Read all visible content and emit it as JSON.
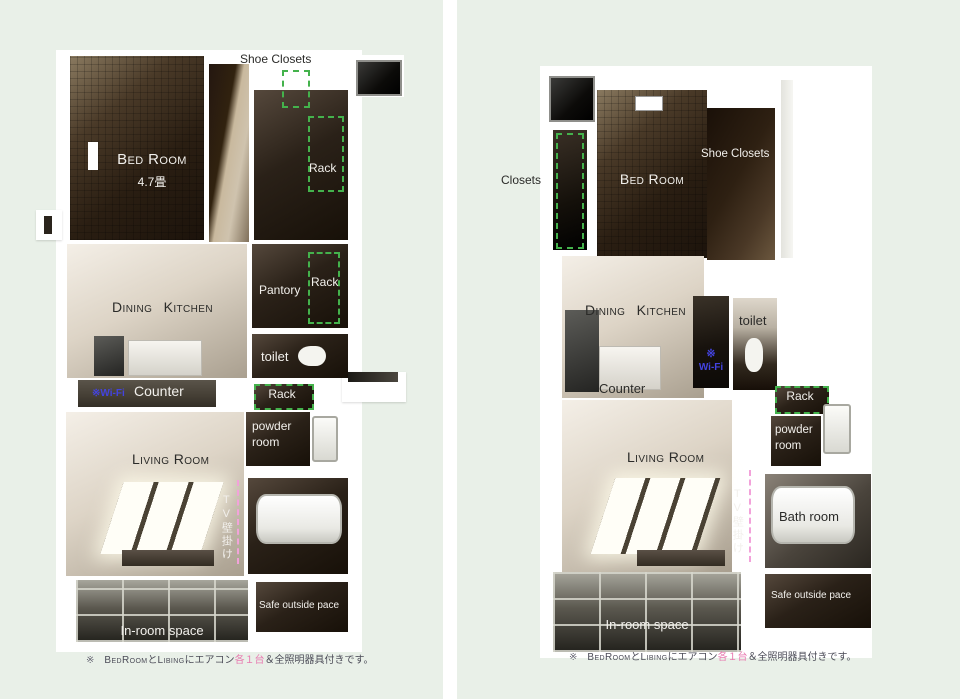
{
  "colors": {
    "page_background": "#ffffff",
    "panel_background": "#e9f0e8",
    "rack_dash_green": "#44b24c",
    "tv_dash_pink": "#f2a2da",
    "wifi_blue": "#4343df",
    "caption_pink": "#e87ab0"
  },
  "caption": {
    "mark": "※",
    "segments": [
      {
        "text": "BedRoom",
        "style": "smallcaps"
      },
      {
        "text": "と",
        "style": "plain"
      },
      {
        "text": "Libing",
        "style": "smallcaps"
      },
      {
        "text": "にエアコン",
        "style": "plain"
      },
      {
        "text": "各１台",
        "style": "pink"
      },
      {
        "text": "＆全照明器具付きです。",
        "style": "plain"
      }
    ]
  },
  "left_plan": {
    "labels": {
      "shoe_closets": "Shoe Closets",
      "bed_room": "Bed Room",
      "bed_room_size": "4.7畳",
      "rack_upper": "Rack",
      "dining_kitchen": "Dining Kitchen",
      "pantory": "Pantory",
      "rack_pantry": "Rack",
      "toilet": "toilet",
      "wifi": "※Wi-Fi",
      "counter": "Counter",
      "rack_lower": "Rack",
      "powder_line1": "powder",
      "powder_line2": "room",
      "living_room": "Living Room",
      "tv_wall": "TV壁掛け",
      "in_room_space": "In-room space",
      "safe_outside": "Safe outside pace"
    }
  },
  "right_plan": {
    "labels": {
      "closets": "Closets",
      "bed_room": "Bed Room",
      "shoe_closets": "Shoe Closets",
      "dining_kitchen": "Dining Kitchen",
      "toilet": "toilet",
      "wifi_mark": "※",
      "wifi": "Wi-Fi",
      "counter": "Counter",
      "rack": "Rack",
      "powder_line1": "powder",
      "powder_line2": "room",
      "living_room": "Living Room",
      "tv_wall": "TV壁掛け",
      "bath_room": "Bath room",
      "safe_outside": "Safe outside pace",
      "in_room_space": "In-room space"
    }
  }
}
